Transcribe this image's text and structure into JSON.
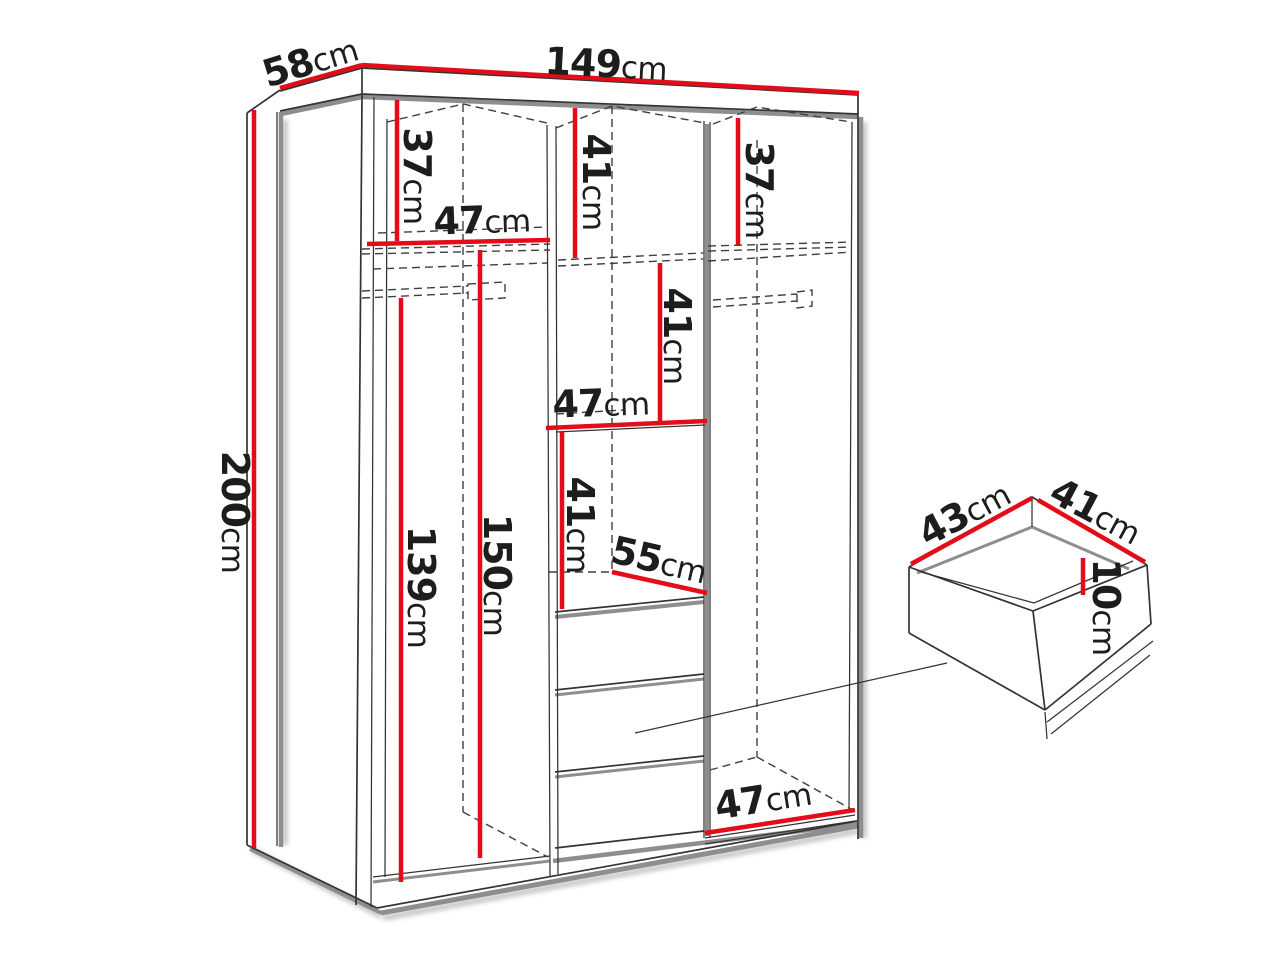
{
  "figure": {
    "type": "furniture-dimension-diagram",
    "subject": "wardrobe interior dimension drawing with drawer inset",
    "unit": "cm",
    "overall_cm": {
      "width": 149,
      "depth": 58,
      "height": 200
    },
    "drawer_inset_cm": {
      "width": 43,
      "depth": 41,
      "height": 10
    },
    "interior_dimensions_cm": [
      37,
      47,
      41,
      37,
      41,
      47,
      41,
      55,
      139,
      150,
      47
    ]
  },
  "labels": {
    "d58": {
      "value": "58",
      "unit": "cm"
    },
    "d149": {
      "value": "149",
      "unit": "cm"
    },
    "d200": {
      "value": "200",
      "unit": "cm"
    },
    "d37_left": {
      "value": "37",
      "unit": "cm"
    },
    "d47_left": {
      "value": "47",
      "unit": "cm"
    },
    "d41_top": {
      "value": "41",
      "unit": "cm"
    },
    "d37_right": {
      "value": "37",
      "unit": "cm"
    },
    "d41_mid": {
      "value": "41",
      "unit": "cm"
    },
    "d47_mid": {
      "value": "47",
      "unit": "cm"
    },
    "d41_low": {
      "value": "41",
      "unit": "cm"
    },
    "d55": {
      "value": "55",
      "unit": "cm"
    },
    "d139": {
      "value": "139",
      "unit": "cm"
    },
    "d150": {
      "value": "150",
      "unit": "cm"
    },
    "d47_bottom": {
      "value": "47",
      "unit": "cm"
    },
    "d43_drawer": {
      "value": "43",
      "unit": "cm"
    },
    "d41_drawer": {
      "value": "41",
      "unit": "cm"
    },
    "d10_drawer": {
      "value": "10",
      "unit": "cm"
    }
  },
  "colors": {
    "red": "#e20d18",
    "outline": "#333333",
    "shadow": "#8e8e8e",
    "dash": "#3f3f3f",
    "text": "#1d1d1b",
    "soft": "#c9c9c9",
    "background": "#ffffff"
  }
}
